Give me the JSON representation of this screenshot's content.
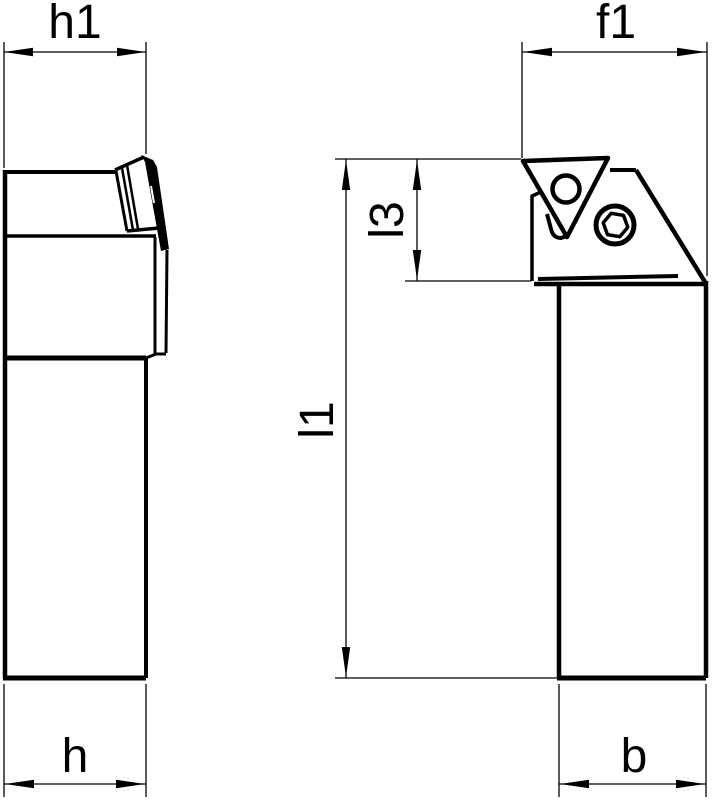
{
  "drawing": {
    "type": "technical-drawing",
    "subject": "tool-holder-two-views",
    "colors": {
      "line": "#000000",
      "background": "#ffffff"
    },
    "dimensions": {
      "h1": "h1",
      "f1": "f1",
      "l3": "l3",
      "l1": "l1",
      "h": "h",
      "b": "b"
    }
  }
}
